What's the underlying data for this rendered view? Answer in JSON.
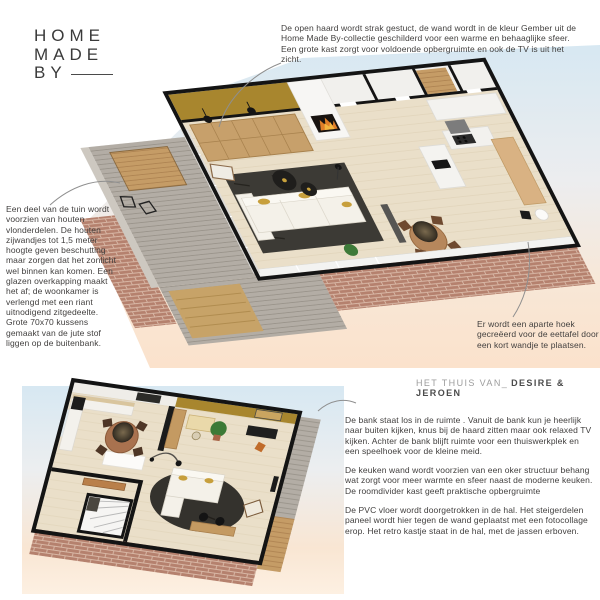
{
  "logo": {
    "line1": "HOME",
    "line2": "MADE",
    "line3": "BY"
  },
  "caption": {
    "prefix": "HET THUIS VAN_",
    "names": "DESIRE & JEROEN"
  },
  "notes": {
    "fireplace": "De open haard wordt strak gestuct, de wand wordt in de kleur Gember uit de Home Made By-collectie geschilderd voor een warme en behaaglijke sfeer. Een grote kast zorgt voor voldoende opbergruimte en ook de TV is uit het zicht.",
    "garden": "Een deel van de tuin wordt voorzien van houten vlonderdelen. De houten zijwandjes tot 1,5 meter hoogte geven beschutting maar zorgen dat het zonlicht wel binnen kan komen. Een glazen overkapping maakt het af; de woonkamer is verlengd met een riant uitnodigend zitgedeelte. Grote 70x70 kussens gemaakt van de jute stof liggen op de buitenbank.",
    "dining": "Er wordt een aparte hoek gecreëerd voor de eettafel door een kort wandje te plaatsen.",
    "sofa": "De bank staat los in de ruimte . Vanuit de bank kun je heerlijk naar buiten kijken, knus bij de haard zitten maar ook relaxed TV kijken. Achter de bank blijft ruimte voor een thuiswerkplek en een speelhoek voor de kleine meid.",
    "kitchen": "De keuken wand wordt voorzien van een oker structuur behang wat zorgt voor meer warmte en sfeer naast de moderne keuken. De roomdivider kast geeft praktische opbergruimte",
    "hall": "De PVC vloer wordt doorgetrokken in de hal. Het steigerdelen paneel wordt hier tegen de wand geplaatst met een fotocollage erop. Het retro kastje staat in de hal, met de jassen erboven."
  },
  "colors": {
    "accent_ochre_gember": "#a8862e",
    "brick": "#b5816e",
    "sky": "#d7e8f2",
    "peach": "#fbe2cc",
    "rug": "#3c3a35",
    "cabinet_wood": "#c7a06b",
    "floor": "#eadfc9",
    "text": "#3f3e3e"
  }
}
